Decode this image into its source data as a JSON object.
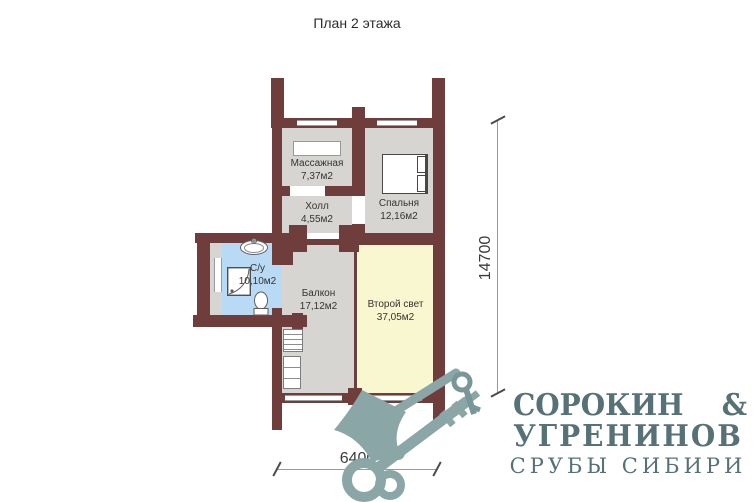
{
  "title": "План 2 этажа",
  "rooms": {
    "massage": {
      "name": "Массажная",
      "area": "7,37м2"
    },
    "hall": {
      "name": "Холл",
      "area": "4,55м2"
    },
    "bedroom": {
      "name": "Спальня",
      "area": "12,16м2"
    },
    "bathroom": {
      "name": "С/у",
      "area": "10,10м2"
    },
    "balcony": {
      "name": "Балкон",
      "area": "17,12м2"
    },
    "second_light": {
      "name": "Второй свет",
      "area": "37,05м2"
    }
  },
  "dimensions": {
    "height": "14700",
    "width": "6400"
  },
  "logo": {
    "part1": "СОРОКИН",
    "amp": "&",
    "line2": "УГРЕНИНОВ",
    "line3": "СРУБЫ СИБИРИ"
  },
  "colors": {
    "wall": "#6f3d3b",
    "floor": "#d7d5d2",
    "bathroom_floor": "#b8daf4",
    "second_light_floor": "#f9f7d0",
    "label_text": "#363330",
    "logo_text": "#567276",
    "watermark": "#8ba6a6",
    "watermark_dark": "#79969a"
  }
}
